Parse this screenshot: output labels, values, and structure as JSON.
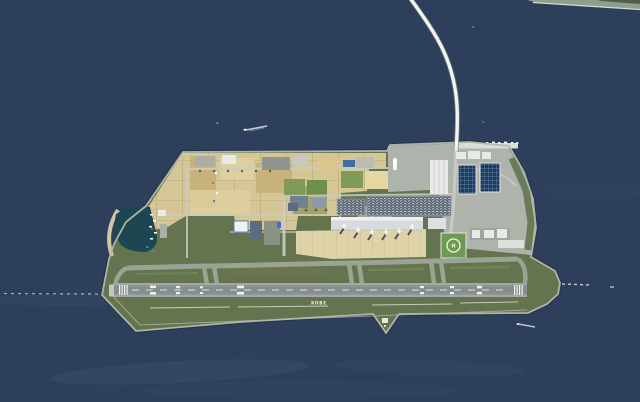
{
  "scene": {
    "description": "Aerial photograph of an artificial island airport in a dark blue sea, connected to the mainland by a long curving bridge",
    "ground_marking": "KOBE",
    "helipad_letter": "H",
    "colors": {
      "sea": "#2d3f5a",
      "sea_streak": "#49627f",
      "mainland": "#8f9f8c",
      "mainland_trees": "#4e6148",
      "surf_line": "#e9ede8",
      "island_grass": "#63744e",
      "island_shadow_rim": "#1d2b40",
      "seawall": "#b5b9ac",
      "reclaimed_sand": "#d5c795",
      "sand_grid_line": "#bfae7e",
      "sand_dark": "#c6b27a",
      "sand_pale": "#ddcf9f",
      "sand_bright": "#e6d7a2",
      "field_green": "#7f9b57",
      "field_green_dark": "#6f8f4c",
      "olive_patch": "#9aa06b",
      "developed_gray": "#aeb3ac",
      "road_light": "#c9ccc4",
      "runway": "#8e9493",
      "runway_dark": "#848a8a",
      "runway_pad": "#c3c7c0",
      "runway_marking": "#eff1ee",
      "taxiway": "#9ba394",
      "infield_stripe": "#7d9258",
      "infield_olive": "#77764f",
      "apron": "#ded2a8",
      "apron_line": "#c9bc92",
      "terminal_roof": "#d7dbde",
      "terminal_canopy": "#edeff0",
      "terminal_edge": "#b7bcc0",
      "jetbridge_dark": "#4a5260",
      "aircraft_white": "#fdfdfb",
      "aircraft_shadow": "#343c49",
      "parking_base": "#5c6878",
      "car_white": "#e8ebee",
      "car_silver": "#9aa3ad",
      "building_white": "#e7eae7",
      "building_rib": "#c2c7c4",
      "building_dark_blue": "#24395a",
      "building_panel_grid": "#4a6e96",
      "building_blue_gray": "#5b6b80",
      "building_gray_green": "#8b9284",
      "building_blue_accent": "#3f6fd0",
      "sign_blue": "#3a6ea5",
      "tower_white": "#f6f8f5",
      "marina_water": "#1c4652",
      "marina_wall": "#d9cfa6",
      "boat_red": "#b04040",
      "boat_teal": "#3e8f8a",
      "helipad_green": "#6f9a53",
      "helipad_white": "#f4f6f2",
      "hedge_green": "#4d6839",
      "bridge_deck": "#f3f5f2",
      "bridge_casing": "#7d8a84",
      "breakwater": "#d4d8d4",
      "wake_white": "#f8fafa",
      "drain_line": "#e6e9e2"
    }
  }
}
